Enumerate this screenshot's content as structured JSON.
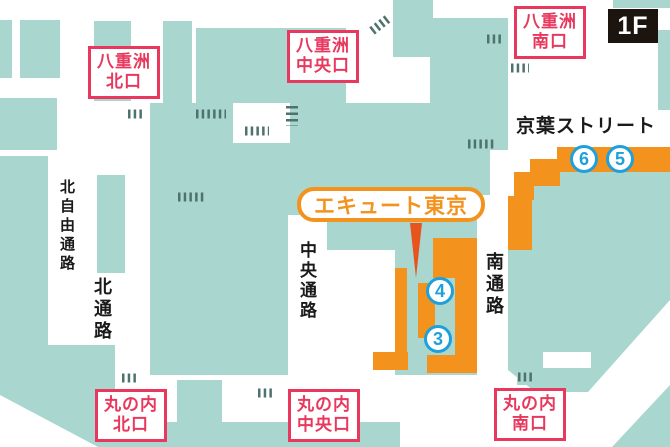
{
  "floor": "1F",
  "street": {
    "keiyo": "京葉ストリート"
  },
  "highlight": {
    "label": "エキュート東京"
  },
  "exits": {
    "yaesu_north": {
      "line1": "八重洲",
      "line2": "北口"
    },
    "yaesu_central": {
      "line1": "八重洲",
      "line2": "中央口"
    },
    "yaesu_south": {
      "line1": "八重洲",
      "line2": "南口"
    },
    "marunouchi_north": {
      "line1": "丸の内",
      "line2": "北口"
    },
    "marunouchi_central": {
      "line1": "丸の内",
      "line2": "中央口"
    },
    "marunouchi_south": {
      "line1": "丸の内",
      "line2": "南口"
    }
  },
  "passages": {
    "north_free": "北自由通路",
    "north": "北通路",
    "central": "中央通路",
    "south": "南通路"
  },
  "markers": {
    "m3": "3",
    "m4": "4",
    "m5": "5",
    "m6": "6"
  },
  "colors": {
    "building": "#aad6d0",
    "orange": "#f3931e",
    "pointer": "#e8541d",
    "red": "#e8385e",
    "blue": "#1ea0db",
    "tick": "#4e736e",
    "badge": "#1b140f",
    "text": "#1a1a1a"
  }
}
